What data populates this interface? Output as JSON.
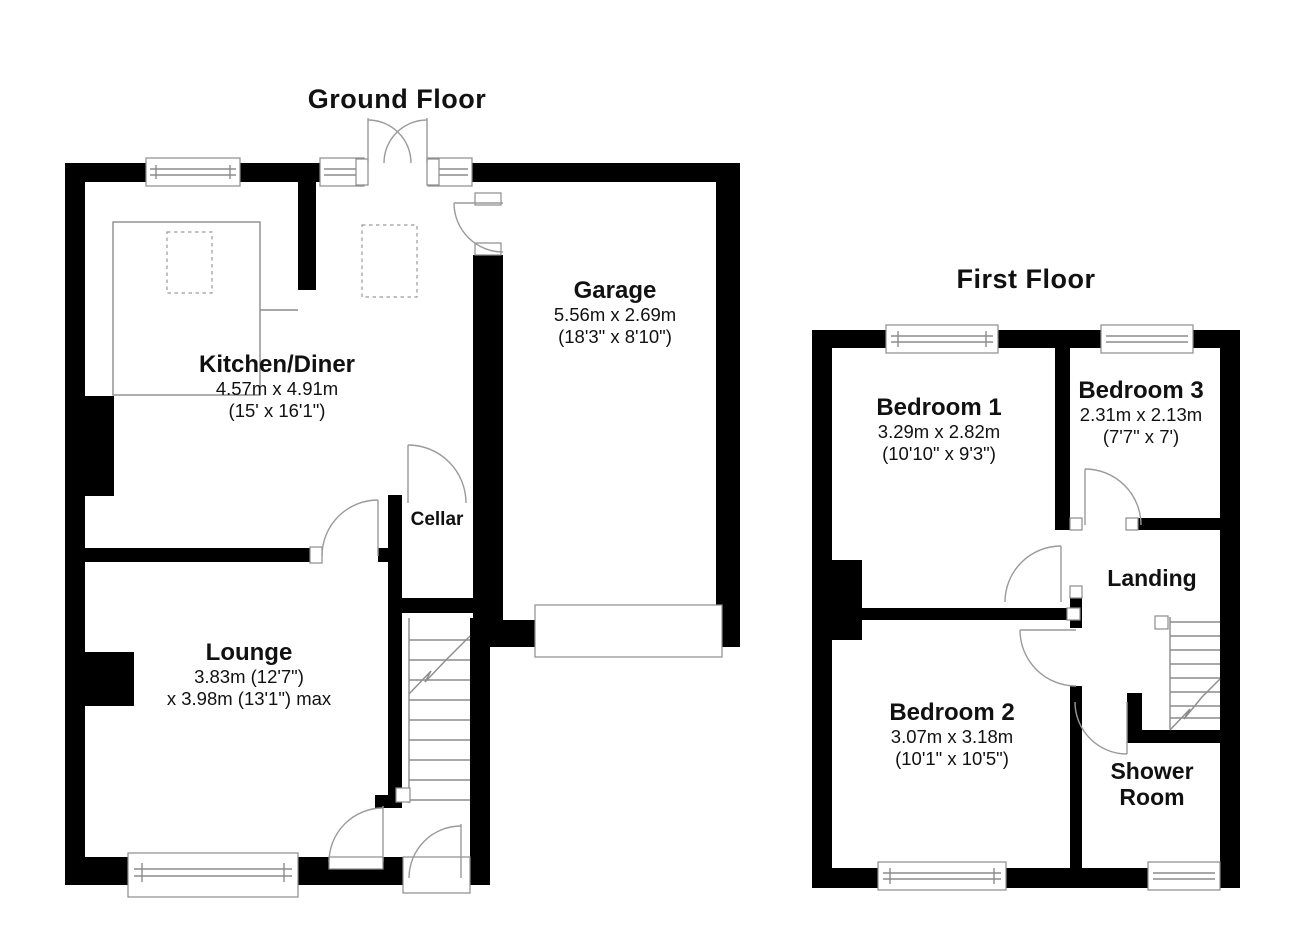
{
  "ground_floor": {
    "title": "Ground Floor",
    "rooms": {
      "kitchen": {
        "name": "Kitchen/Diner",
        "dim_metric": "4.57m x 4.91m",
        "dim_imperial": "(15' x 16'1\")"
      },
      "garage": {
        "name": "Garage",
        "dim_metric": "5.56m x 2.69m",
        "dim_imperial": "(18'3\" x 8'10\")"
      },
      "cellar": {
        "name": "Cellar"
      },
      "lounge": {
        "name": "Lounge",
        "dim_line1": "3.83m (12'7\")",
        "dim_line2": "x 3.98m (13'1\") max"
      }
    }
  },
  "first_floor": {
    "title": "First Floor",
    "rooms": {
      "bedroom1": {
        "name": "Bedroom 1",
        "dim_metric": "3.29m x 2.82m",
        "dim_imperial": "(10'10\" x 9'3\")"
      },
      "bedroom3": {
        "name": "Bedroom 3",
        "dim_metric": "2.31m x 2.13m",
        "dim_imperial": "(7'7\" x 7')"
      },
      "landing": {
        "name": "Landing"
      },
      "bedroom2": {
        "name": "Bedroom 2",
        "dim_metric": "3.07m x 3.18m",
        "dim_imperial": "(10'1\" x 10'5\")"
      },
      "shower": {
        "name_line1": "Shower",
        "name_line2": "Room"
      }
    }
  },
  "colors": {
    "wall": "#000000",
    "line": "#8c8c8c",
    "text": "#111111",
    "background": "#ffffff"
  }
}
